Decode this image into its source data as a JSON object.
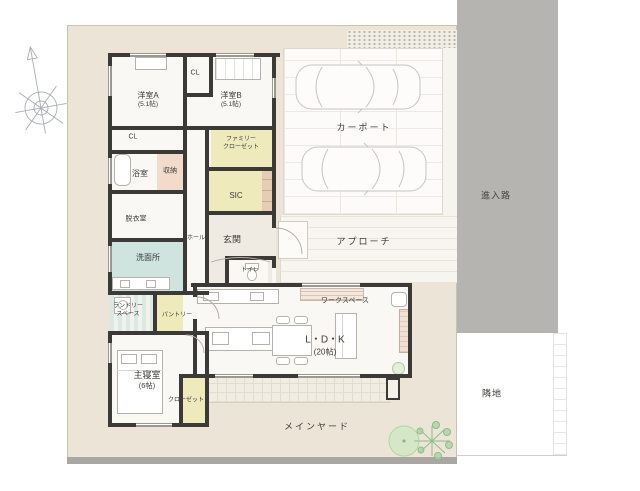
{
  "floorplan": {
    "rooms": {
      "yoshitsuA": {
        "name": "洋室A",
        "size": "(5.1帖)"
      },
      "yoshitsuB": {
        "name": "洋室B",
        "size": "(5.1帖)"
      },
      "clTop": "CL",
      "clLeft": "CL",
      "familyCloset": {
        "line1": "ファミリー",
        "line2": "クローゼット"
      },
      "bath": "浴室",
      "storage": "収納",
      "dressing": "脱衣室",
      "washroom": "洗面所",
      "hall": "ホール",
      "entrance": "玄関",
      "sic": "SIC",
      "toilet": "トイレ",
      "laundry": {
        "line1": "ランドリー",
        "line2": "スペース"
      },
      "pantry": "パントリー",
      "workspace": "ワークスペース",
      "ldk": {
        "name": "L・D・K",
        "size": "(20帖)"
      },
      "master": {
        "name": "主寝室",
        "size": "(6帖)"
      },
      "closet": "クローゼット"
    },
    "outdoor": {
      "carport": "カーポート",
      "approach": "アプローチ",
      "road": "進入路",
      "adjacent": "隣地",
      "mainYard": "メインヤード"
    },
    "colors": {
      "site": "#ece4d7",
      "road": "#b5b4b1",
      "wall": "#3c3a36",
      "closet_floor": "#efeabc",
      "washroom_floor": "#cfe3df",
      "storage_floor": "#f2dbcb"
    }
  }
}
